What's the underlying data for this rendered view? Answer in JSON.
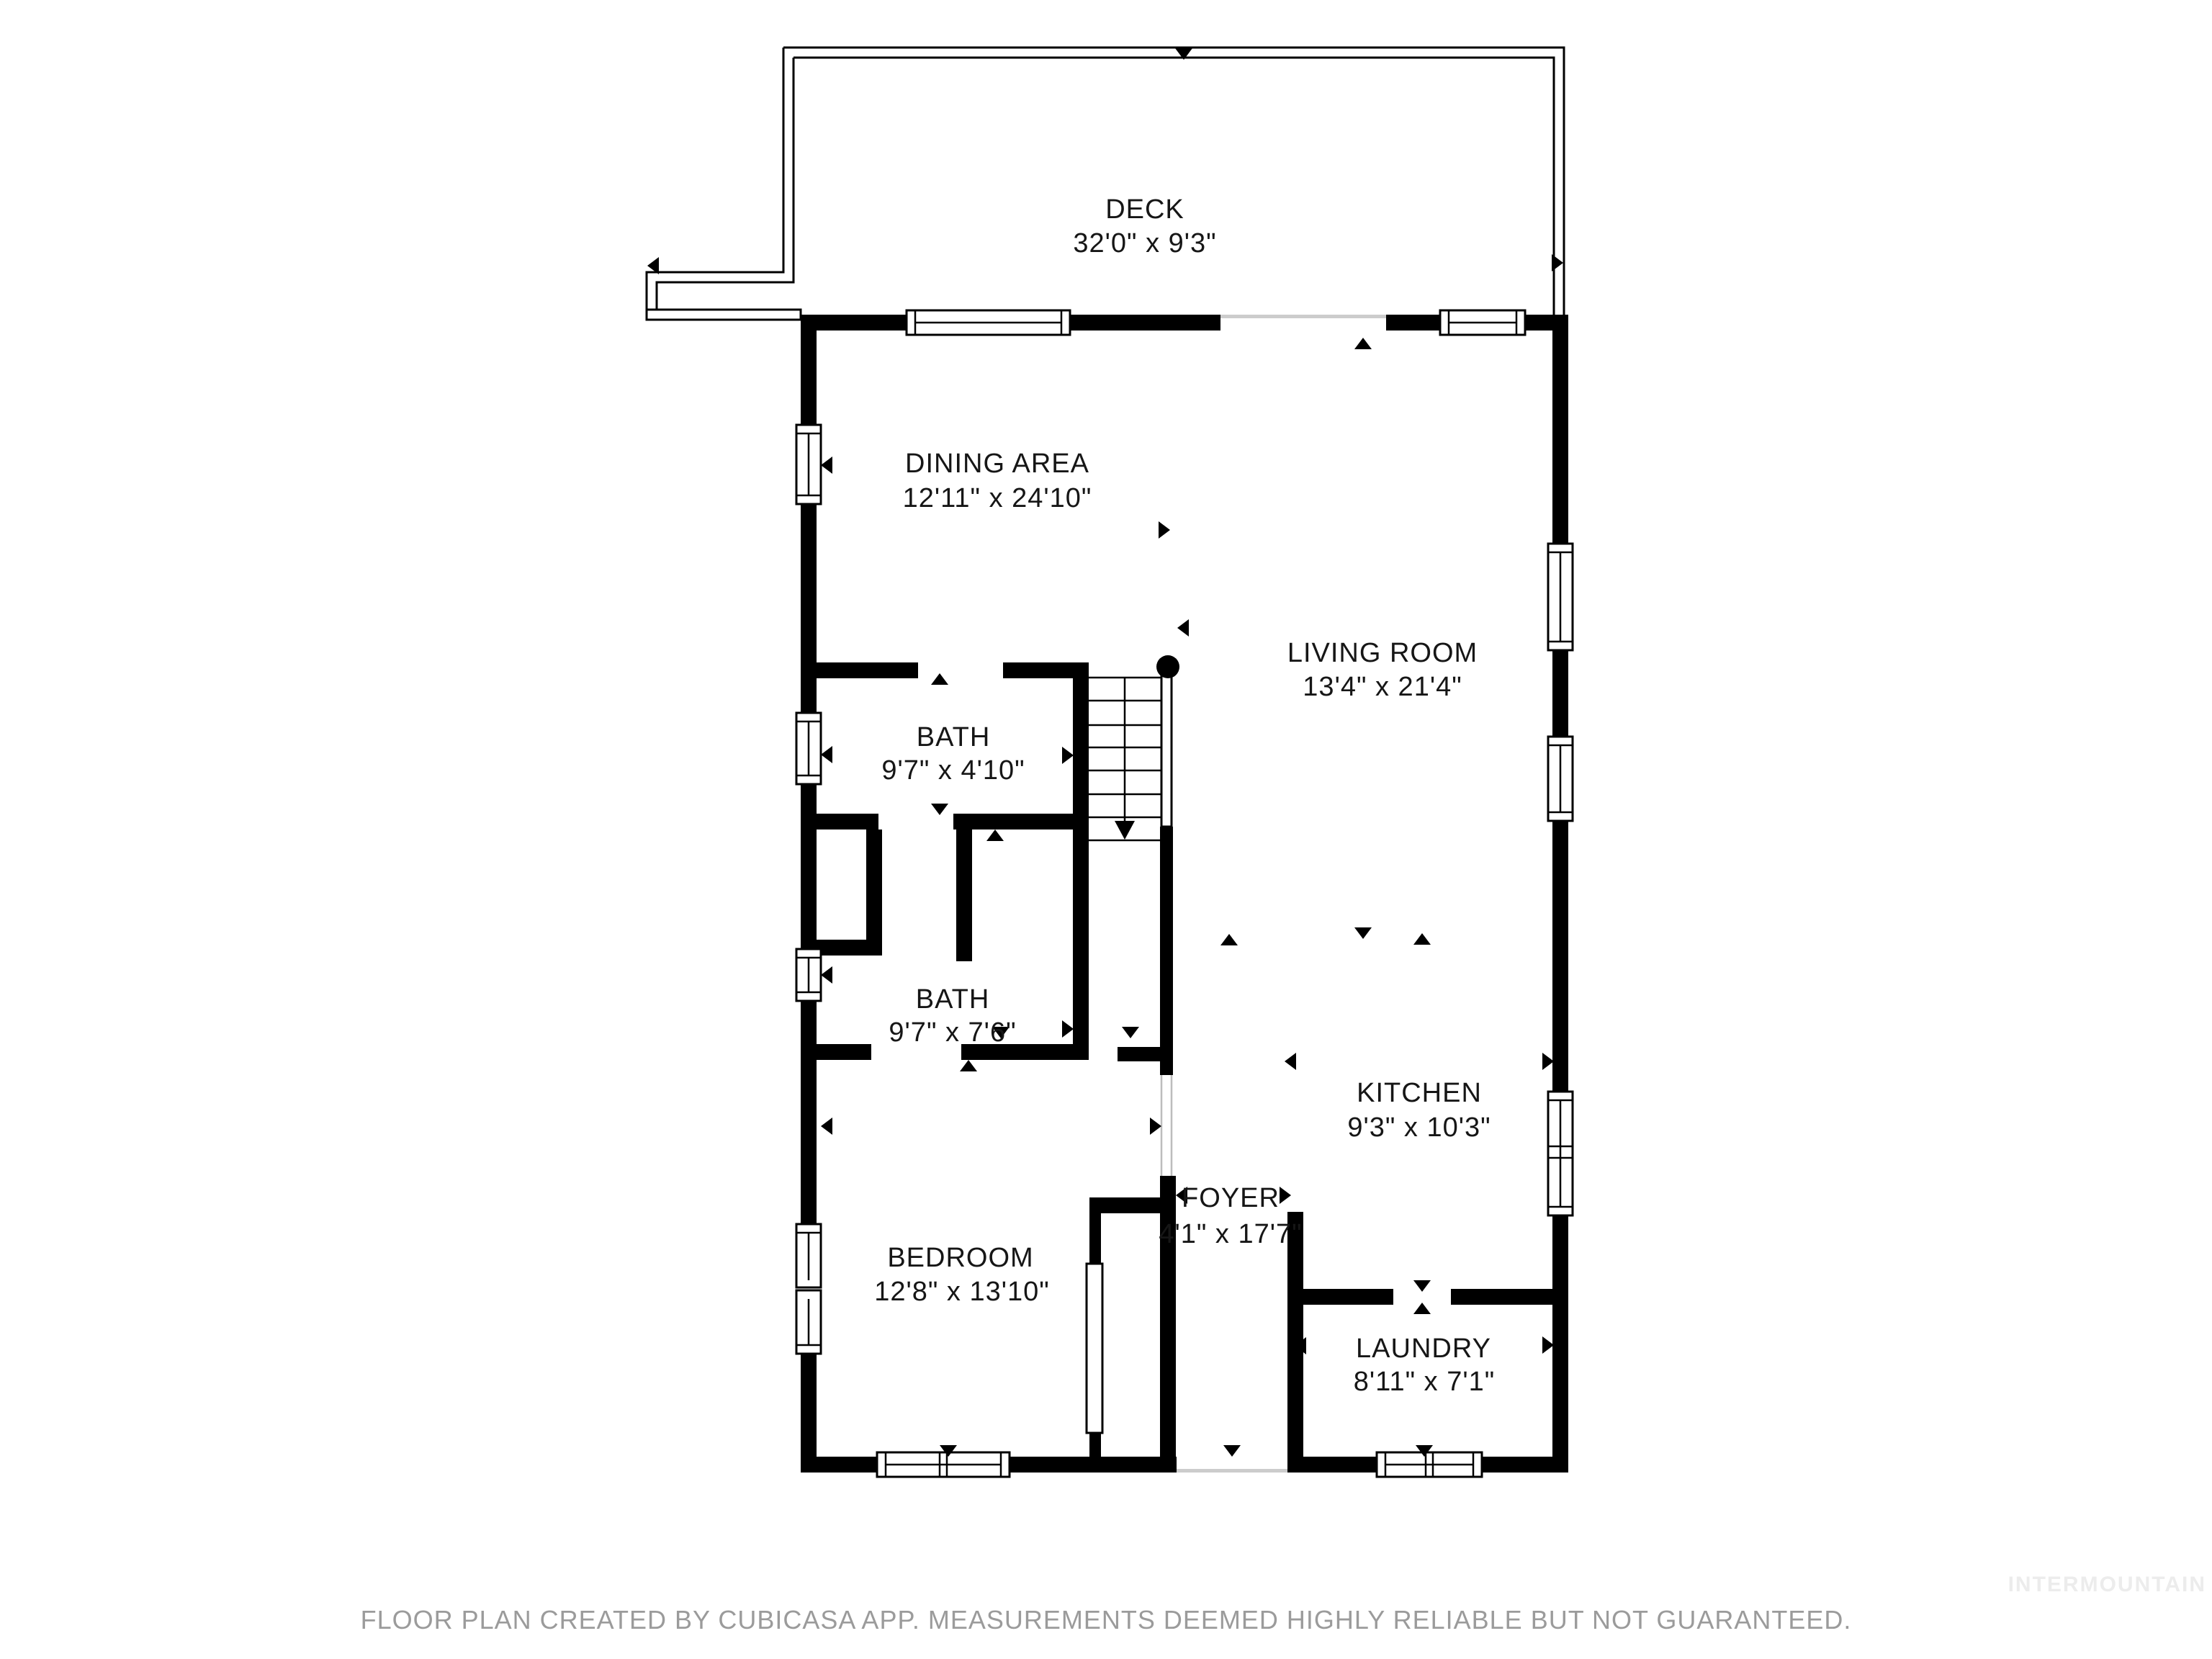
{
  "footer": {
    "disclaimer": "FLOOR PLAN CREATED BY CUBICASA APP. MEASUREMENTS DEEMED HIGHLY RELIABLE BUT NOT GUARANTEED.",
    "watermark": "INTERMOUNTAIN"
  },
  "colors": {
    "wall": "#000000",
    "background": "#ffffff",
    "disclaimer_text": "#9b9b9b",
    "watermark_text": "#ececec"
  },
  "rooms": [
    {
      "id": "deck",
      "name": "DECK",
      "dimensions": "32'0\" x 9'3\""
    },
    {
      "id": "dining-area",
      "name": "DINING AREA",
      "dimensions": "12'11\" x 24'10\""
    },
    {
      "id": "living-room",
      "name": "LIVING ROOM",
      "dimensions": "13'4\" x 21'4\""
    },
    {
      "id": "bath-upper",
      "name": "BATH",
      "dimensions": "9'7\" x 4'10\""
    },
    {
      "id": "bath-lower",
      "name": "BATH",
      "dimensions": "9'7\" x 7'6\""
    },
    {
      "id": "bedroom",
      "name": "BEDROOM",
      "dimensions": "12'8\" x 13'10\""
    },
    {
      "id": "foyer",
      "name": "FOYER",
      "dimensions": "4'1\" x 17'7\""
    },
    {
      "id": "kitchen",
      "name": "KITCHEN",
      "dimensions": "9'3\" x 10'3\""
    },
    {
      "id": "laundry",
      "name": "LAUNDRY",
      "dimensions": "8'11\" x 7'1\""
    }
  ]
}
